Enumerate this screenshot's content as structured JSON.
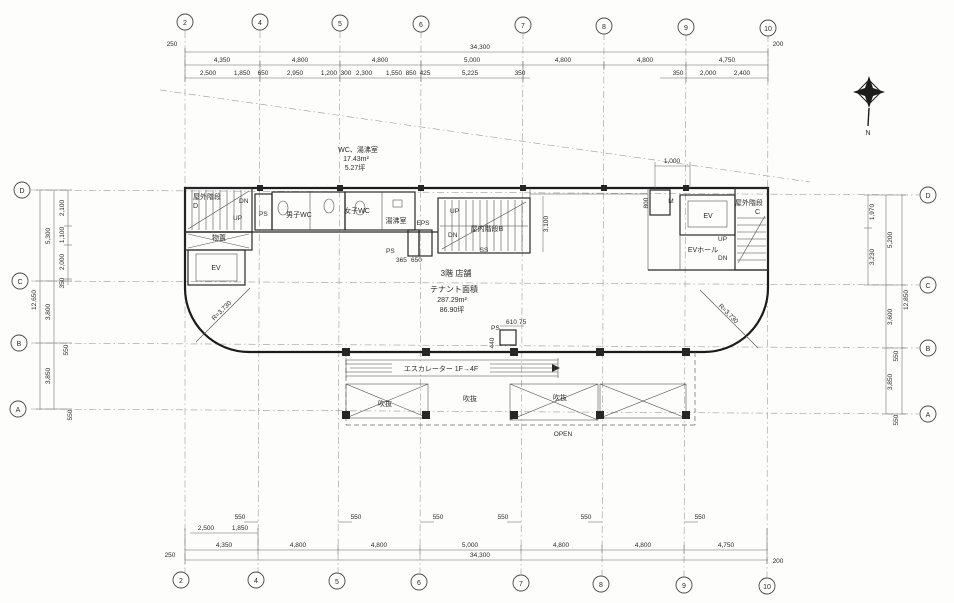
{
  "drawing": {
    "compass": "N",
    "grid_columns": [
      "2",
      "4",
      "5",
      "6",
      "7",
      "8",
      "9",
      "10"
    ],
    "grid_rows": [
      "D",
      "C",
      "B",
      "A"
    ],
    "dims": {
      "top": {
        "offset_left": "250",
        "total": "34,300",
        "offset_right": "200",
        "majors": [
          "4,350",
          "4,800",
          "4,800",
          "5,000",
          "4,800",
          "4,800",
          "4,750"
        ],
        "minors": [
          "2,500",
          "1,850",
          "650",
          "2,950",
          "1,200",
          "300",
          "2,300",
          "1,550",
          "850",
          "425",
          "5,225",
          "350"
        ],
        "minors_right": [
          "350",
          "2,000",
          "2,400"
        ]
      },
      "bottom": {
        "offset_left": "250",
        "total": "34,300",
        "offset_right": "200",
        "majors": [
          "4,350",
          "4,800",
          "4,800",
          "5,000",
          "4,800",
          "4,800",
          "4,750"
        ],
        "minors": [
          "2,500",
          "1,850"
        ],
        "offsets": [
          "550",
          "550",
          "550",
          "550",
          "550",
          "550"
        ]
      },
      "left": {
        "total": "12,650",
        "majors": [
          "5,300",
          "3,800",
          "3,850"
        ],
        "minors": [
          "2,100",
          "1,100",
          "2,000",
          "350"
        ],
        "offsets": [
          "550",
          "550"
        ]
      },
      "right": {
        "total": "12,850",
        "majors": [
          "5,200",
          "3,600",
          "3,850"
        ],
        "minors": [
          "1,970",
          "3,230"
        ],
        "offsets": [
          "550",
          "550"
        ]
      },
      "inner": {
        "d1000": "1,000",
        "d800": "800",
        "d3100": "3,100",
        "d365": "365",
        "d650": "650",
        "d610": "610",
        "d75a": "75",
        "d440": "440"
      }
    },
    "rooms": {
      "stair_left": "屋外階段",
      "stair_left_tag": "D",
      "storage": "物置",
      "ev_left": "EV",
      "ps_left": "PS",
      "wc_men": "男子WC",
      "wc_women": "女子WC",
      "kitchen": "湯沸室",
      "eps": "EPS",
      "ps_mid": "PS",
      "stair_center": "屋内階段B",
      "ss": "SS",
      "meter": "M",
      "ev_right": "EV",
      "ev_hall": "EVホール",
      "stair_right": "屋外階段",
      "stair_right_tag": "C",
      "ps_esc": "PS",
      "void1": "吹抜",
      "void2": "吹抜",
      "void3": "吹抜",
      "open": "OPEN",
      "up1": "UP",
      "dn1": "DN",
      "up2": "UP",
      "dn2": "DN",
      "up3": "UP",
      "dn3": "DN"
    },
    "annotations": {
      "wc_area_title": "WC、湯沸室",
      "wc_area_m2": "17.43m²",
      "wc_area_tsubo": "5.27坪",
      "floor_title": "3階 店舗",
      "tenant_label": "テナント面積",
      "tenant_m2": "287.29m²",
      "tenant_tsubo": "86.90坪",
      "radius_left": "R=3,730",
      "radius_right": "R=3,730",
      "escalator": "エスカレーター 1F→4F"
    }
  }
}
